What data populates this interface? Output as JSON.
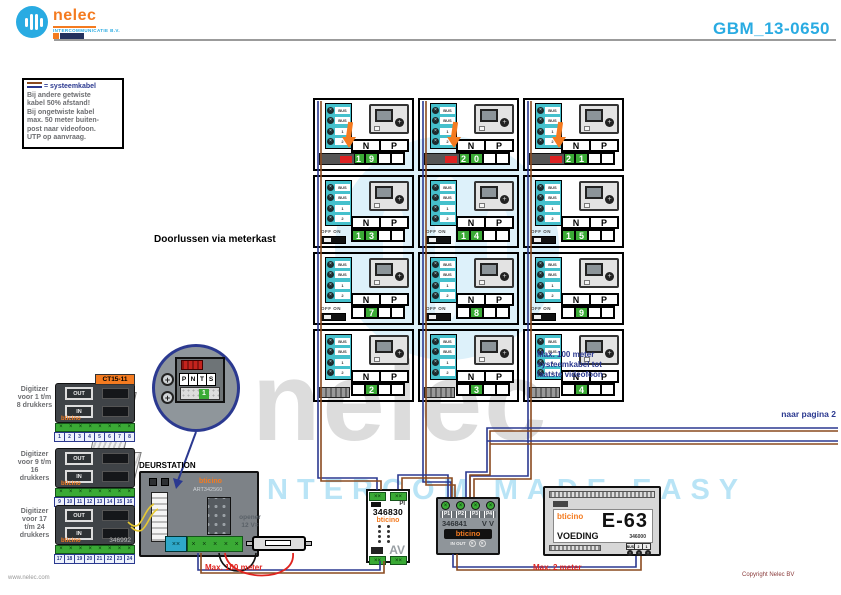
{
  "header": {
    "brand": "nelec",
    "brand_tagline": "intercommunicatie b.v.",
    "doc_number": "GBM_13-0650"
  },
  "note_box": {
    "legend_suffix": "= systeemkabel",
    "lines": [
      "Bij andere getwiste",
      "kabel 50% afstand!",
      "Bij ongetwiste kabel",
      "max. 50 meter buiten-",
      "post naar videofoon.",
      "UTP op aanvraag."
    ]
  },
  "annotations": {
    "doorlussen": "Doorlussen via meterkast",
    "max_system": [
      "Max. 100 meter",
      "systeemkabel tot",
      "laatste videofoon"
    ],
    "naar_pagina": "naar pagina 2",
    "max_100": "Max. 100 meter",
    "max_2": "Max. 2 meter",
    "opener_line1": "opener",
    "opener_line2": "12 V=",
    "deurstation_title": "DEURSTATION"
  },
  "grid": {
    "terminal_labels": [
      "BUS",
      "BUS",
      "1",
      "2"
    ],
    "table_headers": [
      "N",
      "P"
    ],
    "switch_label": "OFF ON",
    "units": [
      {
        "row": 0,
        "col": 0,
        "digits": [
          "1",
          "9"
        ],
        "connector": "arrow"
      },
      {
        "row": 0,
        "col": 1,
        "digits": [
          "2",
          "0"
        ],
        "connector": "arrow"
      },
      {
        "row": 0,
        "col": 2,
        "digits": [
          "2",
          "1"
        ],
        "connector": "arrow"
      },
      {
        "row": 1,
        "col": 0,
        "digits": [
          "1",
          "3"
        ],
        "connector": "offon"
      },
      {
        "row": 1,
        "col": 1,
        "digits": [
          "1",
          "4"
        ],
        "connector": "offon"
      },
      {
        "row": 1,
        "col": 2,
        "digits": [
          "1",
          "5"
        ],
        "connector": "offon"
      },
      {
        "row": 2,
        "col": 0,
        "digits": [
          "",
          "7"
        ],
        "connector": "offon"
      },
      {
        "row": 2,
        "col": 1,
        "digits": [
          "",
          "8"
        ],
        "connector": "offon"
      },
      {
        "row": 2,
        "col": 2,
        "digits": [
          "",
          "9"
        ],
        "connector": "offon"
      },
      {
        "row": 3,
        "col": 0,
        "digits": [
          "",
          "2"
        ],
        "connector": "plug"
      },
      {
        "row": 3,
        "col": 1,
        "digits": [
          "",
          "3"
        ],
        "connector": "plug"
      },
      {
        "row": 3,
        "col": 2,
        "digits": [
          "",
          "4"
        ],
        "connector": "plug"
      }
    ]
  },
  "digitizers": [
    {
      "label": "Digitizer voor 1 t/m 8 drukkers",
      "tag": "CT15-11",
      "part": "",
      "numbers": [
        "1",
        "2",
        "3",
        "4",
        "5",
        "6",
        "7",
        "8"
      ]
    },
    {
      "label": "Digitizer voor 9 t/m 16 drukkers",
      "tag": "",
      "part": "",
      "numbers": [
        "9",
        "10",
        "11",
        "12",
        "13",
        "14",
        "15",
        "16"
      ]
    },
    {
      "label": "Digitizer voor 17 t/m 24 drukkers",
      "tag": "",
      "part": "346992",
      "numbers": [
        "17",
        "18",
        "19",
        "20",
        "21",
        "22",
        "23",
        "24"
      ]
    }
  ],
  "digitizer_common": {
    "out": "OUT",
    "in": "IN",
    "brand": "bticino"
  },
  "detail_circle": {
    "labels": [
      "P",
      "N",
      "T",
      "S"
    ],
    "value": "1"
  },
  "deurstation": {
    "brand": "bticino",
    "part": "ART342560"
  },
  "module_346830": {
    "pi": "PI",
    "part": "346830",
    "brand": "bticino",
    "av": "AV"
  },
  "module_346841": {
    "ports": [
      "P1",
      "P2",
      "P3",
      "P4"
    ],
    "part": "346841",
    "vv": "V V",
    "brand": "bticino",
    "io": "IN OUT"
  },
  "power_supply": {
    "brand": "bticino",
    "model": "E-63",
    "label": "VOEDING",
    "part": "346000",
    "terminals": [
      "BUS",
      "2",
      "1"
    ]
  },
  "watermark": {
    "word": "nelec",
    "tagline": "INTERCOM MADE EASY"
  },
  "footer": {
    "website": "www.nelec.com",
    "copyright": "Copyright Nelec BV"
  },
  "colors": {
    "accent_cyan": "#29abe2",
    "orange": "#f47b20",
    "wire_blue": "#2b3990",
    "wire_brown": "#8a4a1f",
    "alert_red": "#e0241f",
    "green_cell": "#3aaa35",
    "terminal_teal": "#45c0cc"
  }
}
